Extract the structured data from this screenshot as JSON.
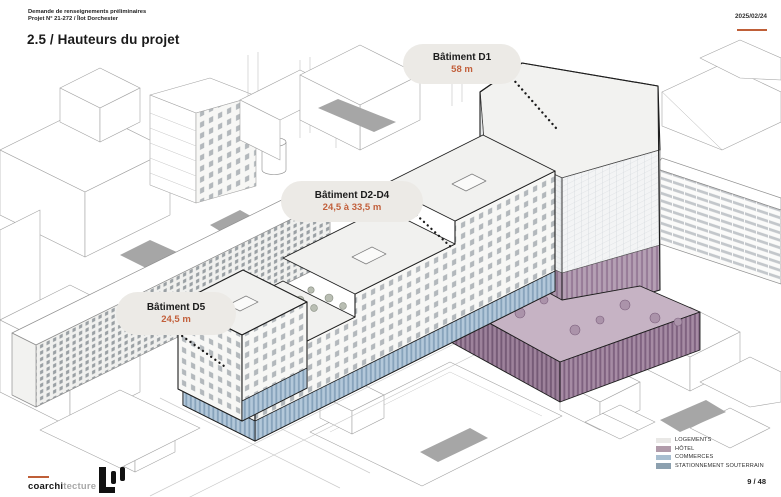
{
  "header": {
    "line1": "Demande de renseignements préliminaires",
    "line2": "Projet N° 21-272 / Îlot Dorchester",
    "date": "2025/02/24",
    "title": "2.5 / Hauteurs du projet"
  },
  "annotations": [
    {
      "name": "Bâtiment D1",
      "height": "58 m"
    },
    {
      "name": "Bâtiment D2-D4",
      "height": "24,5 à 33,5 m"
    },
    {
      "name": "Bâtiment D5",
      "height": "24,5 m"
    }
  ],
  "legend": {
    "items": [
      {
        "label": "LOGEMENTS",
        "color": "#e9e8e6"
      },
      {
        "label": "HÔTEL",
        "color": "#b19baa"
      },
      {
        "label": "COMMERCES",
        "color": "#a8bed0"
      },
      {
        "label": "STATIONNEMENT SOUTERRAIN",
        "color": "#8ca0af"
      }
    ]
  },
  "footer": {
    "brand_bold": "coarchi",
    "brand_light": "tecture",
    "page": "9 / 48"
  },
  "colors": {
    "accent": "#bf5f38",
    "hotel": "#b19baa",
    "commerces": "#a8bed0",
    "stationnement": "#8ca0af",
    "logements": "#e9e8e6"
  }
}
